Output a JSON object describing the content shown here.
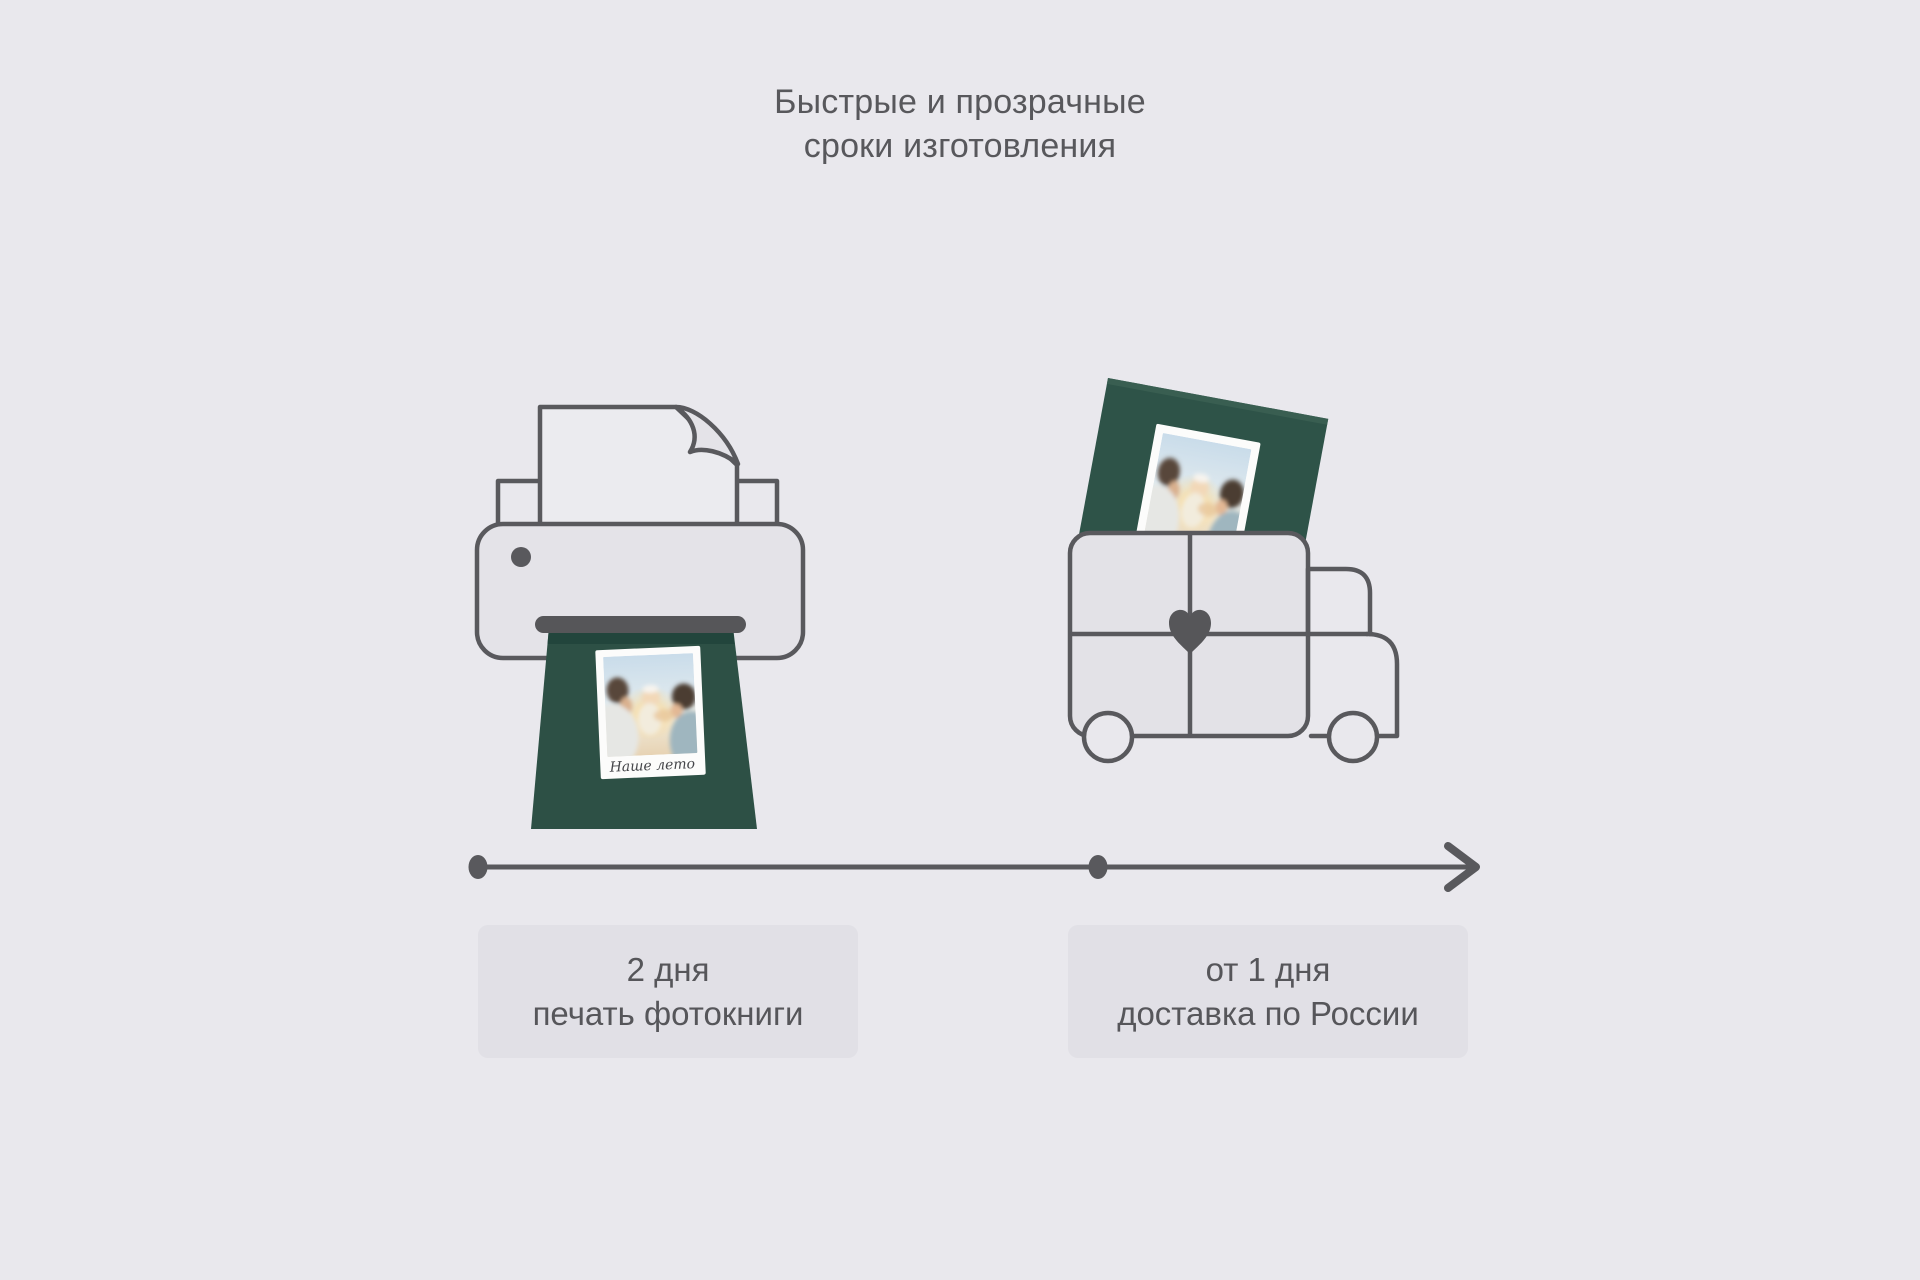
{
  "title": {
    "line1": "Быстрые и прозрачные",
    "line2": "сроки изготовления"
  },
  "illustrations": {
    "printer": {
      "description": "printer printing a green photobook",
      "book_caption": "Наше лето"
    },
    "truck": {
      "description": "delivery van with heart, carrying green photobook"
    }
  },
  "timeline": {
    "steps": [
      {
        "duration": "2 дня",
        "label": "печать фотокниги"
      },
      {
        "duration": "от 1 дня",
        "label": "доставка по России"
      }
    ]
  },
  "colors": {
    "background": "#e9e8ed",
    "stroke_gray": "#59595d",
    "fill_gray": "#e4e3e8",
    "card_background": "#e1e0e6",
    "text": "#56565a",
    "book_green": "#2d5045",
    "slot_dark": "#565659"
  }
}
